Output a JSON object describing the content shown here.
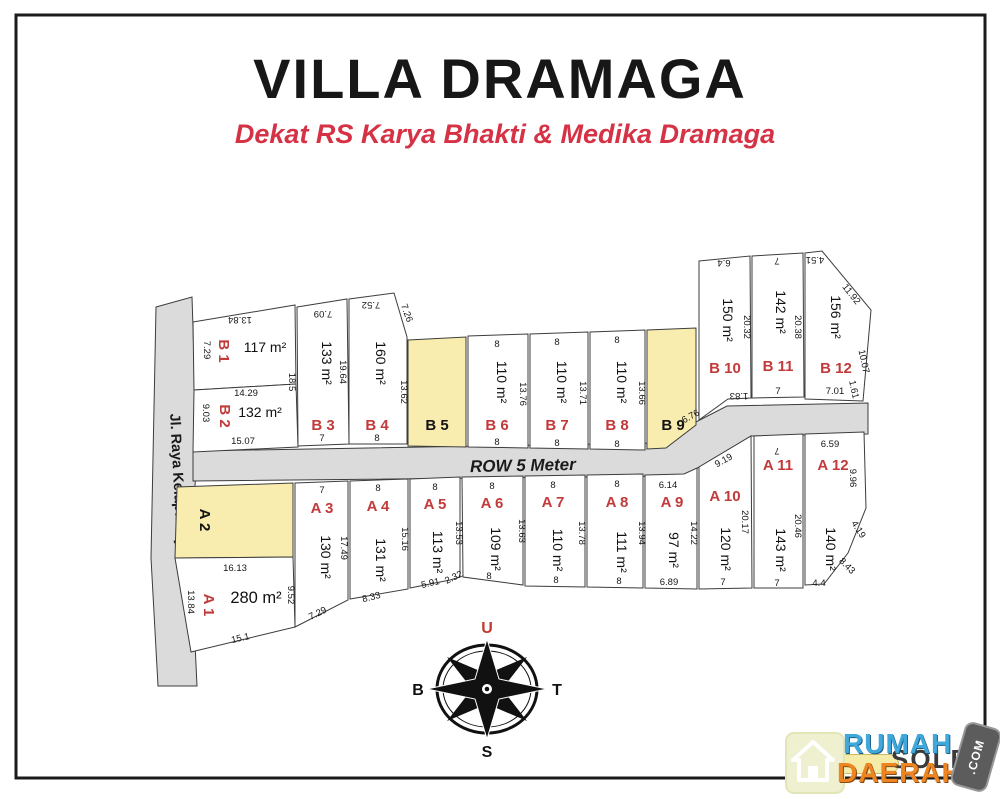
{
  "title": "VILLA DRAMAGA",
  "subtitle": "Dekat RS Karya Bhakti & Medika Dramaga",
  "road": {
    "label": "ROW 5 Meter"
  },
  "street": {
    "label": "Jl. Raya Kelapa Tujuh"
  },
  "compass": {
    "north": "U",
    "east": "T",
    "south": "S",
    "west": "B"
  },
  "logo": {
    "name_top": "RUMAH",
    "name_bottom": "DAERAH",
    "badge": ".COM",
    "watermark": "SOLD"
  },
  "colors": {
    "accent_red": "#C23A3A",
    "title_red": "#D63245",
    "highlight_yellow": "#F8EDAE",
    "road_gray": "#DBDBDB"
  },
  "plots": {
    "a1": {
      "label": "A 1",
      "area": "280 m²"
    },
    "a2": {
      "label": "A 2"
    },
    "a3": {
      "label": "A 3",
      "area": "130 m²"
    },
    "a4": {
      "label": "A 4",
      "area": "131 m²"
    },
    "a5": {
      "label": "A 5",
      "area": "113 m²"
    },
    "a6": {
      "label": "A 6",
      "area": "109 m²"
    },
    "a7": {
      "label": "A 7",
      "area": "110 m²"
    },
    "a8": {
      "label": "A 8",
      "area": "111 m²"
    },
    "a9": {
      "label": "A 9",
      "area": "97 m²"
    },
    "a10": {
      "label": "A 10",
      "area": "120 m²"
    },
    "a11": {
      "label": "A 11",
      "area": "143 m²"
    },
    "a12": {
      "label": "A 12",
      "area": "140 m²"
    },
    "b1": {
      "label": "B 1",
      "area": "117 m²"
    },
    "b2": {
      "label": "B 2",
      "area": "132 m²"
    },
    "b3": {
      "label": "B 3",
      "area": "133 m²"
    },
    "b4": {
      "label": "B 4",
      "area": "160 m²"
    },
    "b5": {
      "label": "B 5"
    },
    "b6": {
      "label": "B 6",
      "area": "110 m²"
    },
    "b7": {
      "label": "B 7",
      "area": "110 m²"
    },
    "b8": {
      "label": "B 8",
      "area": "110 m²"
    },
    "b9": {
      "label": "B 9"
    },
    "b10": {
      "label": "B 10",
      "area": "150 m²"
    },
    "b11": {
      "label": "B 11",
      "area": "142 m²"
    },
    "b12": {
      "label": "B 12",
      "area": "156 m²"
    }
  },
  "dims": {
    "b1_top": "13.84",
    "b1_left": "7.29",
    "b1_right": "18.5",
    "b1_bottom": "14.29",
    "b2_left": "9.03",
    "b2_bottom": "15.07",
    "b3_top": "7.09",
    "b3_right": "19.64",
    "b3_bottom": "7",
    "b4_top": "7.52",
    "b4_diag": "7.26",
    "b4_right": "13.62",
    "b4_bottom": "8",
    "b6_top": "8",
    "b6_right": "13.76",
    "b6_bottom": "8",
    "b7_top": "8",
    "b7_right": "13.71",
    "b7_bottom": "8",
    "b8_top": "8",
    "b8_right": "13.66",
    "b8_bottom": "8",
    "b10_top": "6.4",
    "b10_right": "20.32",
    "b10_bottom": "1.83",
    "b11_top": "7",
    "b11_right": "20.38",
    "b11_bottom": "7",
    "b12_top": "4.51",
    "b12_diag": "11.92",
    "b12_right1": "10.07",
    "b12_right2": "1.61",
    "b12_bottom": "7.01",
    "road_diag_upper": "6.76",
    "road_diag_lower": "9.19",
    "a1_top": "16.13",
    "a1_left": "13.84",
    "a1_right": "9.52",
    "a1_bottom": "15.1",
    "a3_top": "7",
    "a3_right": "17.49",
    "a3_bottom": "7.29",
    "a4_top": "8",
    "a4_right": "15.16",
    "a4_bottom": "8.33",
    "a5_top": "8",
    "a5_right": "13.53",
    "a5_bottom1": "5.91",
    "a5_bottom2": "2.32",
    "a6_top": "8",
    "a6_right": "13.63",
    "a6_bottom": "8",
    "a7_top": "8",
    "a7_right": "13.78",
    "a7_bottom": "8",
    "a8_top": "8",
    "a8_right": "13.94",
    "a8_bottom": "8",
    "a9_top": "6.14",
    "a9_right": "14.22",
    "a9_bottom": "6.89",
    "a10_right": "20.17",
    "a10_bottom": "7",
    "a11_top": "7",
    "a11_right": "20.46",
    "a11_bottom": "7",
    "a12_top": "6.59",
    "a12_right": "9.96",
    "a12_diag1": "4.19",
    "a12_diag2": "8.43",
    "a12_bottom": "4.4"
  }
}
